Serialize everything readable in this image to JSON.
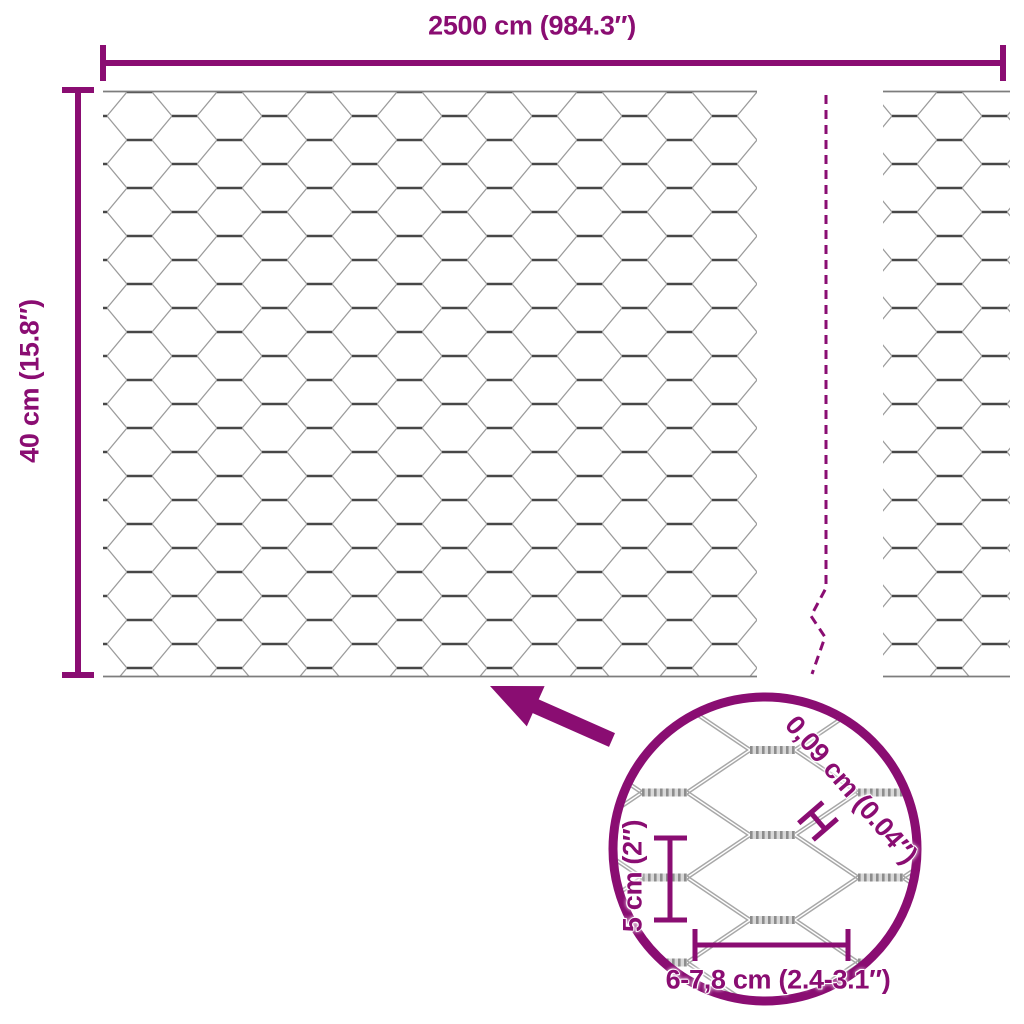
{
  "page": {
    "background": "#ffffff",
    "colors": {
      "accent": "#8A0D72",
      "mesh-dark": "#474747",
      "mesh-light": "#9b9b9b",
      "rope-light": "#d8d8d8",
      "rope-dark": "#8d8d8d",
      "selvedge": "#7d7d7d"
    }
  },
  "diagram": {
    "overall": {
      "width_label": "2500 cm (984.3″)",
      "height_label": "40 cm (15.8″)"
    },
    "detail": {
      "wire_thickness_label": "0,09 cm (0.04″)",
      "cell_height_label": "5 cm (2″)",
      "cell_width_label": "6-7,8 cm (2.4-3.1″)"
    }
  }
}
